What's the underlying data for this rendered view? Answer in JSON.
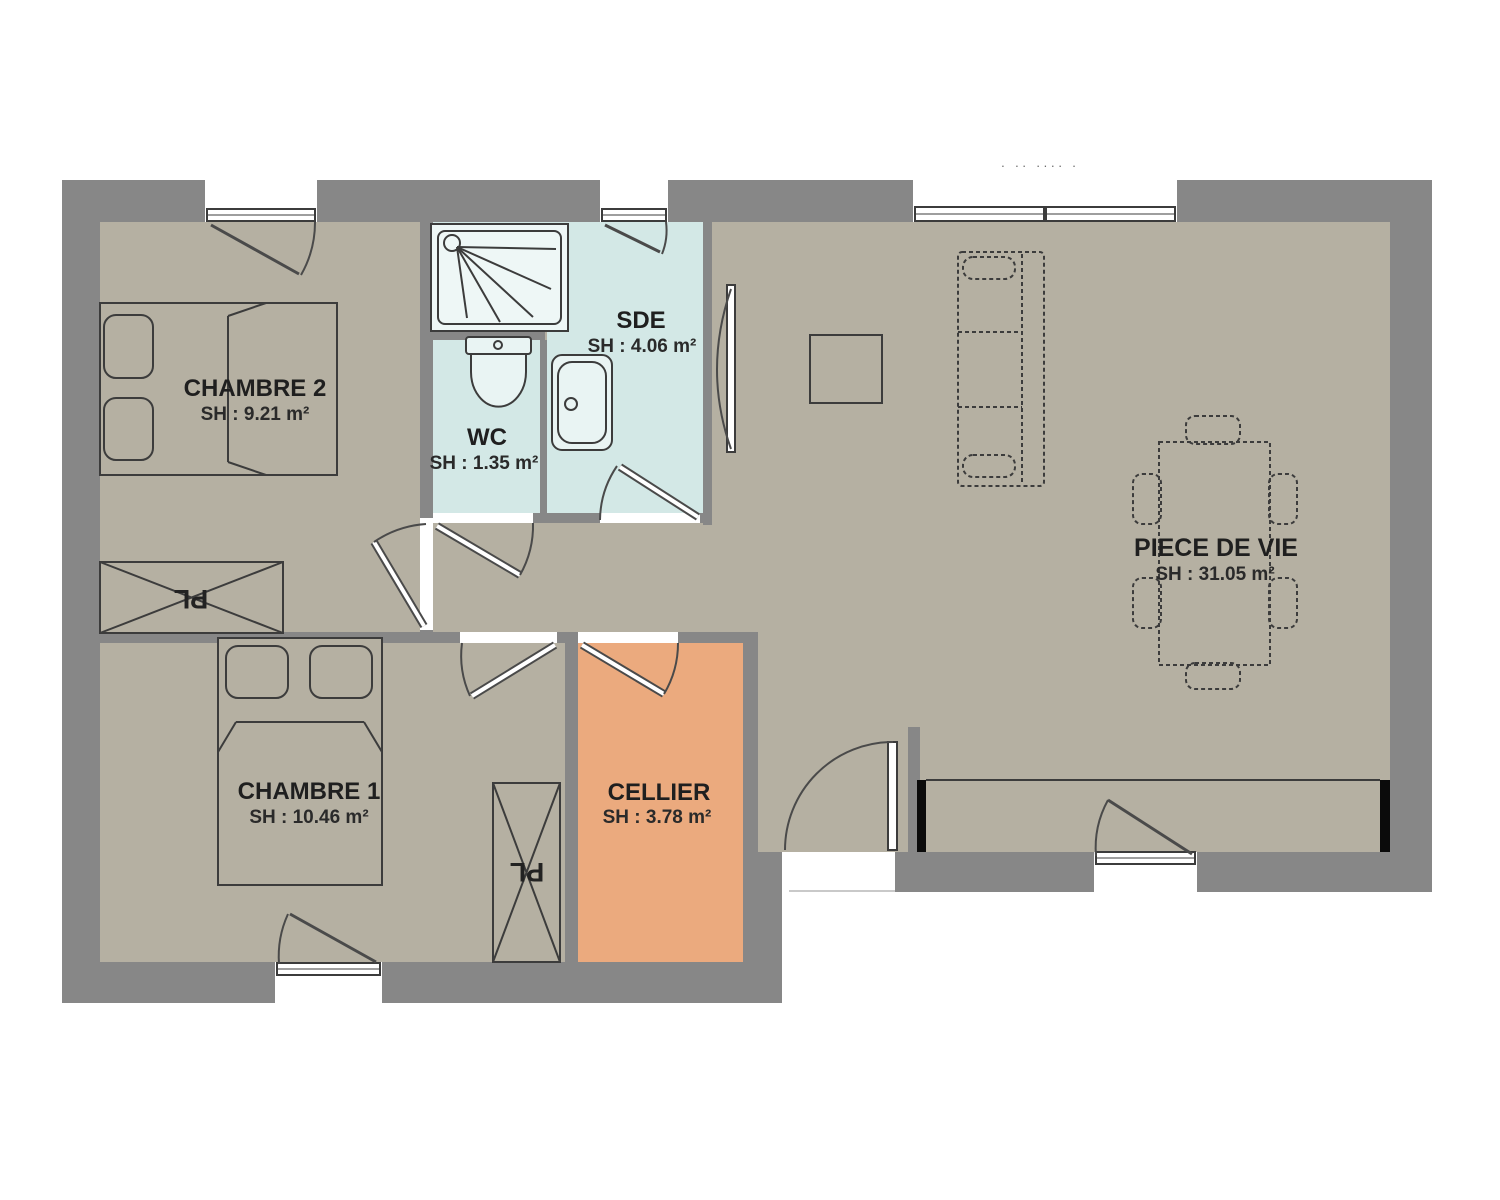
{
  "plan": {
    "title_fragment": "· ·· ···· ·",
    "rooms": [
      {
        "id": "chambre2",
        "name": "CHAMBRE 2",
        "area": "SH : 9.21 m²"
      },
      {
        "id": "wc",
        "name": "WC",
        "area": "SH : 1.35 m²"
      },
      {
        "id": "sde",
        "name": "SDE",
        "area": "SH : 4.06 m²"
      },
      {
        "id": "chambre1",
        "name": "CHAMBRE 1",
        "area": "SH : 10.46 m²"
      },
      {
        "id": "cellier",
        "name": "CELLIER",
        "area": "SH : 3.78 m²"
      },
      {
        "id": "piece_de_vie",
        "name": "PIECE DE VIE",
        "area": "SH : 31.05 m²"
      }
    ],
    "closets": [
      {
        "label": "PL"
      },
      {
        "label": "PL"
      }
    ],
    "colors": {
      "wall": "#878787",
      "floor": "#b5b0a2",
      "wet_room": "#d3e8e6",
      "cellier": "#ebaa7e",
      "outline": "#3c3c3c",
      "wall_end_black": "#0b0b0b"
    }
  }
}
